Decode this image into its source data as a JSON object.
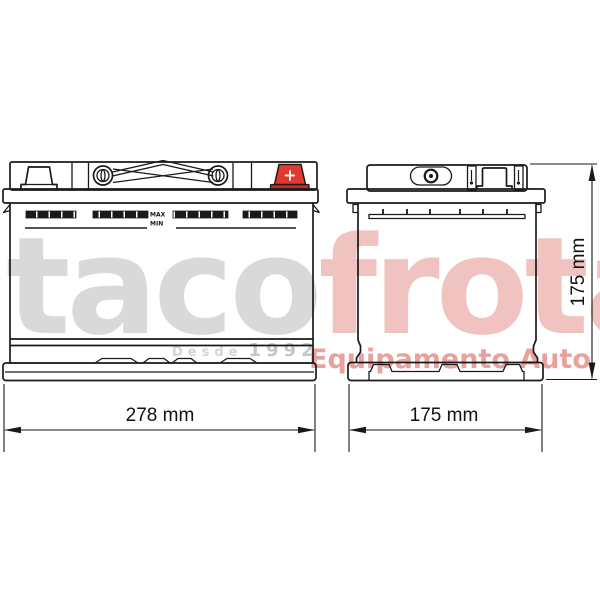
{
  "drawing": {
    "front_view": {
      "max_label": "MAX",
      "min_label": "MIN",
      "positive_terminal_label": "+",
      "width_dimension": "278 mm"
    },
    "side_view": {
      "width_dimension": "175 mm",
      "height_dimension": "175 mm"
    }
  },
  "watermark": {
    "brand_gray": "taco",
    "brand_pink": "frota",
    "tagline_word": "Desde",
    "tagline_year": "1992",
    "subtitle": "Equipamento Auto"
  },
  "colors": {
    "line": "#1a1a1a",
    "terminal_red": "#e23832",
    "terminal_red_dark": "#c92b27",
    "watermark_gray": "#d9d9d9",
    "watermark_pink": "#f1c3c0",
    "watermark_pink_strong": "#e9a19d",
    "tagline_gray": "#d5d5d5",
    "tagline_year_gray": "#c6c6c6"
  }
}
